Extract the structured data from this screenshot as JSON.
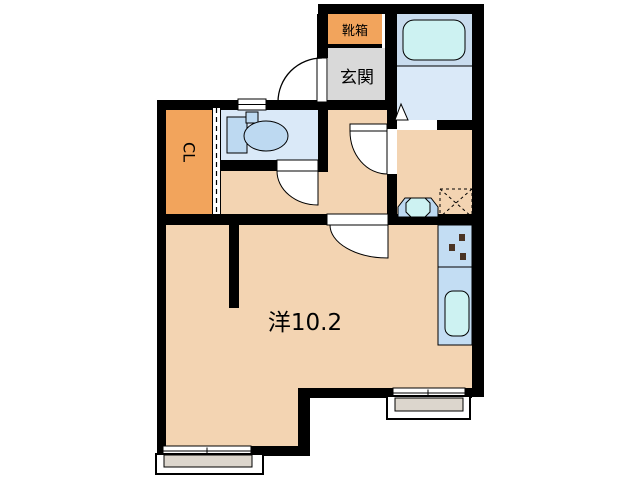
{
  "labels": {
    "shoebox": "靴箱",
    "entrance": "玄関",
    "closet": "CL",
    "main_room": "洋10.2"
  },
  "colors": {
    "room_floor": "#F3D4B2",
    "closet": "#F2A45C",
    "shoebox": "#F2A45C",
    "entrance_floor": "#D9D9D9",
    "wet_room": "#DAE9F8",
    "bath_panel": "#C9DCEE",
    "water": "#CDF2F2",
    "fixture": "#BDD9F1",
    "kitchen_counter": "#C3DDF3",
    "balcony_floor": "#DCD6CD",
    "stove_burner": "#4A3424",
    "wall": "#000000",
    "background": "#FFFFFF"
  }
}
